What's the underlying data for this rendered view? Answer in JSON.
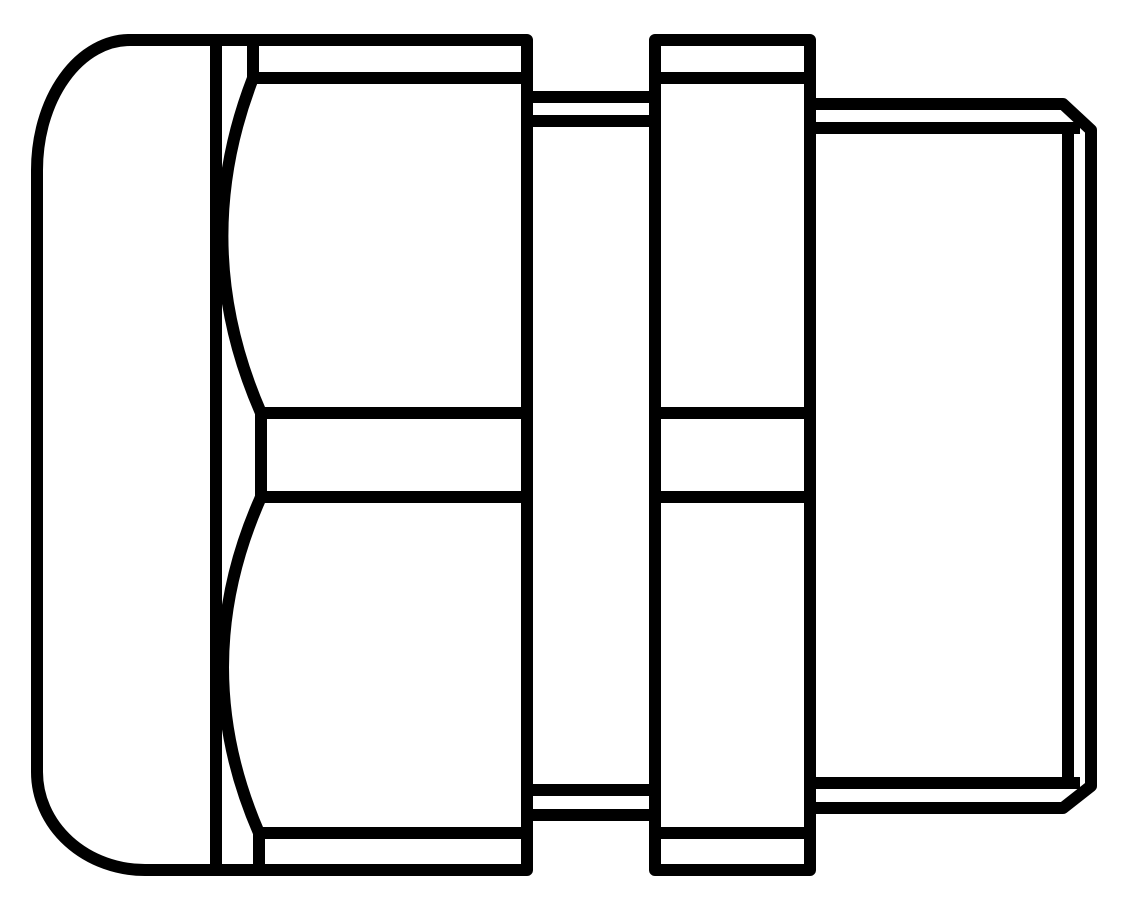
{
  "figure": {
    "kind": "technical-line-drawing",
    "subject": "cable-gland-side-elevation",
    "background_color": "#ffffff",
    "line_color": "#000000",
    "stroke_width": "12",
    "parts": [
      {
        "name": "dome-cap-nut"
      },
      {
        "name": "cap-hex-flats-with-chamfer-arcs"
      },
      {
        "name": "neck-groove"
      },
      {
        "name": "body-hex-nut"
      },
      {
        "name": "threaded-stud-with-chamfered-end"
      }
    ]
  }
}
